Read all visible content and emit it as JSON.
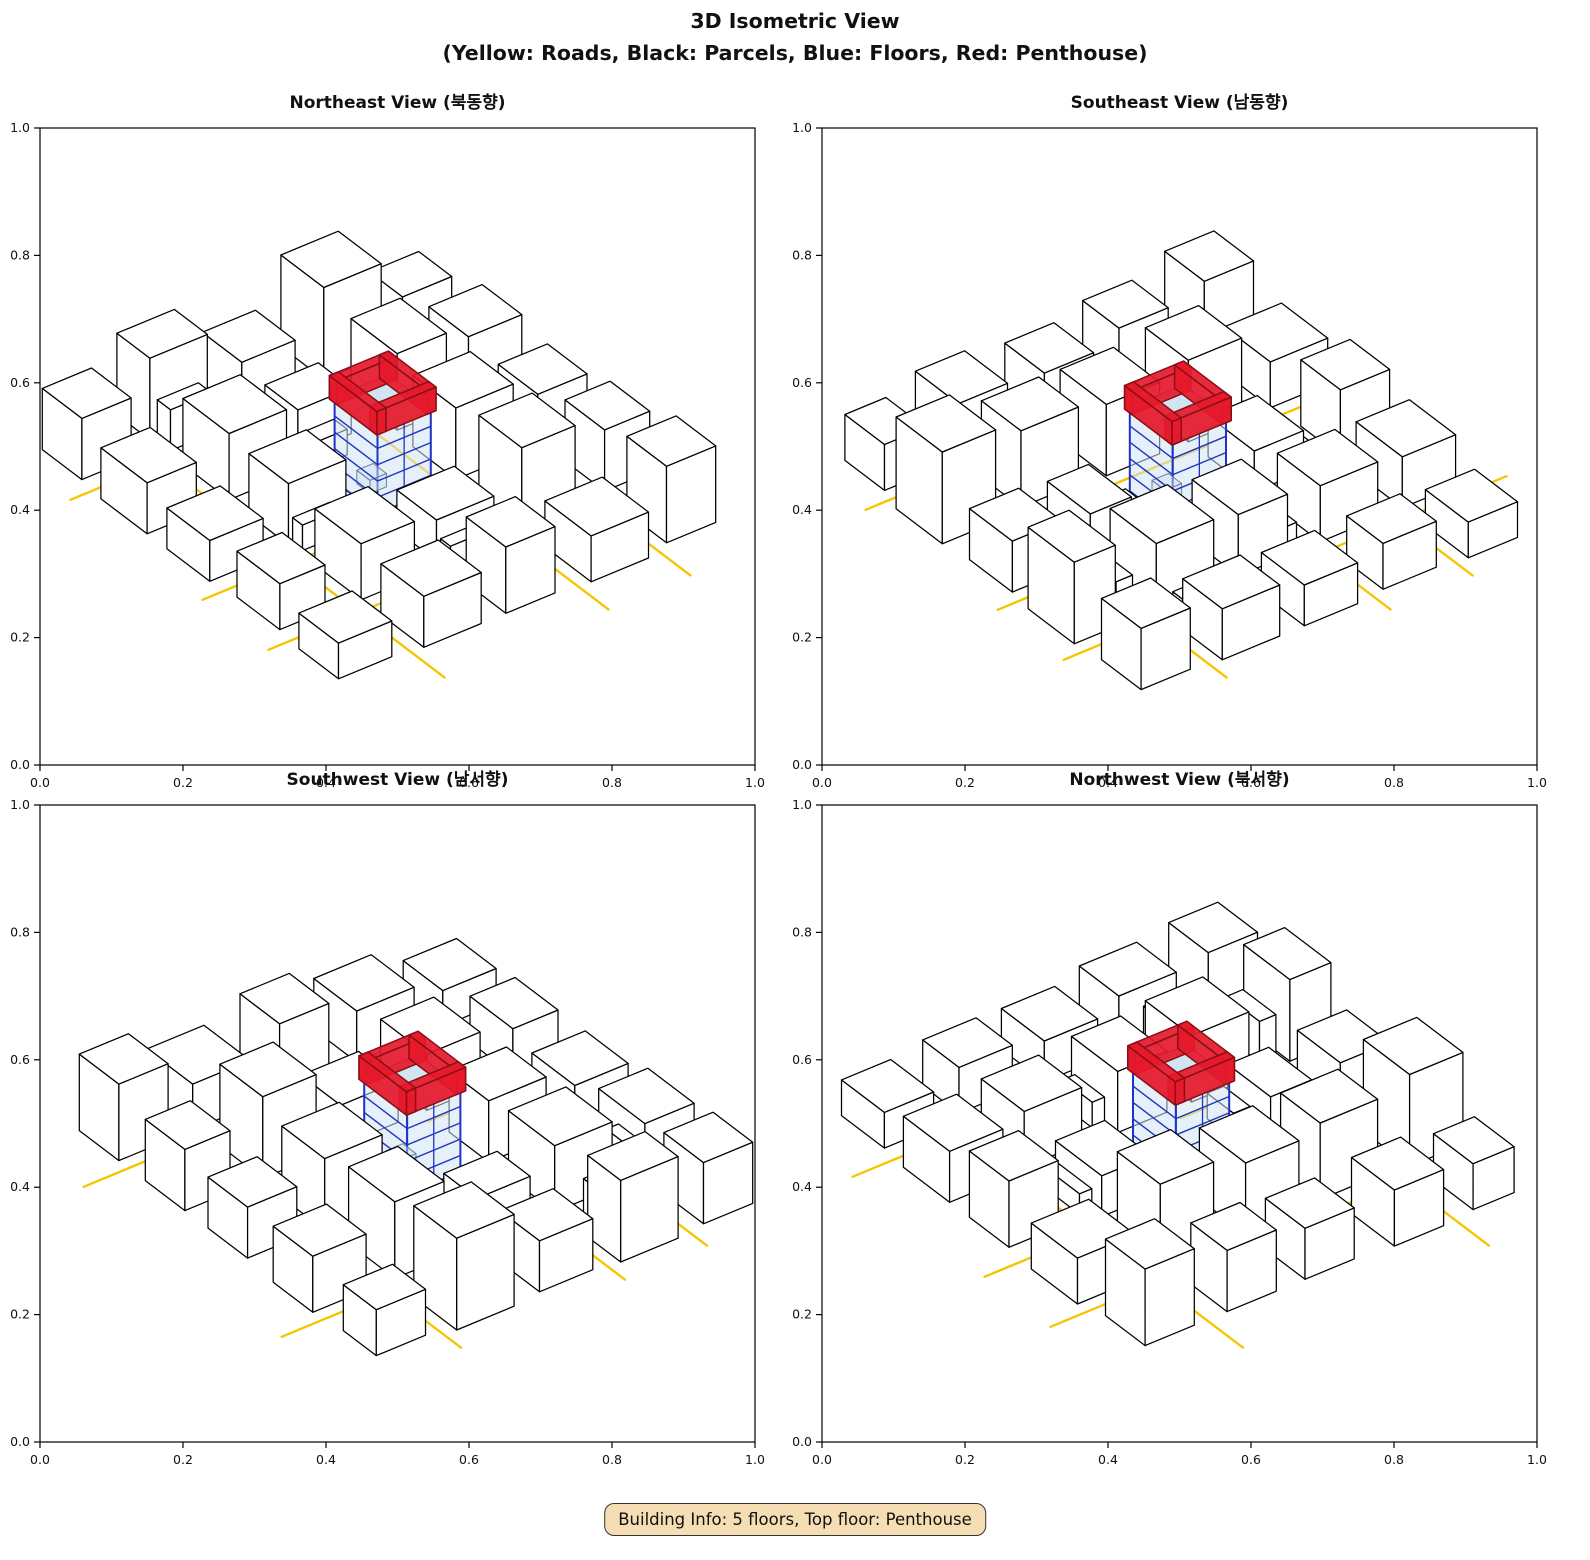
{
  "figure": {
    "title_line1": "3D Isometric View",
    "title_line2": "(Yellow: Roads, Black: Parcels, Blue: Floors, Red: Penthouse)"
  },
  "legend": {
    "roads": "Yellow",
    "parcels": "Black",
    "floors": "Blue",
    "penthouse": "Red"
  },
  "panels": [
    {
      "id": "northeast",
      "title": "Northeast View (북동향)",
      "rotation": 0
    },
    {
      "id": "southeast",
      "title": "Southeast View (남동향)",
      "rotation": 1
    },
    {
      "id": "southwest",
      "title": "Southwest View (남서향)",
      "rotation": 2
    },
    {
      "id": "northwest",
      "title": "Northwest View (북서향)",
      "rotation": 3
    }
  ],
  "axes": {
    "tick_labels": [
      "0.0",
      "0.2",
      "0.4",
      "0.6",
      "0.8",
      "1.0"
    ],
    "min": 0,
    "max": 1
  },
  "badge": {
    "text": "Building Info: 5 floors, Top floor: Penthouse"
  },
  "building_info": {
    "floors": 5,
    "top_floor": "Penthouse"
  },
  "colors": {
    "road": "#F5C500",
    "parcel_edge": "#000000",
    "building_fill": "#FFFFFF",
    "floor_fill": "#CFE3F2",
    "floor_edge": "#2033C4",
    "penthouse_fill": "#E6192B",
    "penthouse_edge": "#8A0E16",
    "badge_bg": "#F5DEB3",
    "badge_border": "#333333"
  },
  "scene": {
    "size": 100,
    "roads": [
      [
        [
          18,
          -4
        ],
        [
          18,
          104
        ]
      ],
      [
        [
          -4,
          18
        ],
        [
          104,
          18
        ]
      ],
      [
        [
          58,
          20
        ],
        [
          58,
          104
        ]
      ],
      [
        [
          -4,
          58
        ],
        [
          36,
          58
        ]
      ],
      [
        [
          78,
          -4
        ],
        [
          78,
          104
        ]
      ],
      [
        [
          -4,
          78
        ],
        [
          104,
          78
        ]
      ],
      [
        [
          38,
          -4
        ],
        [
          38,
          40
        ]
      ]
    ],
    "buildings": [
      [
        2,
        2,
        12,
        12,
        12
      ],
      [
        21,
        1,
        14,
        10,
        16
      ],
      [
        22,
        12,
        10,
        4,
        8
      ],
      [
        41,
        2,
        13,
        12,
        10
      ],
      [
        61,
        1,
        14,
        13,
        18
      ],
      [
        81,
        3,
        12,
        10,
        9
      ],
      [
        1,
        21,
        12,
        14,
        10
      ],
      [
        13,
        21,
        3,
        8,
        6
      ],
      [
        21,
        21,
        14,
        14,
        13
      ],
      [
        41,
        21,
        13,
        10,
        9
      ],
      [
        41,
        32,
        8,
        4,
        5
      ],
      [
        62,
        21,
        12,
        14,
        15
      ],
      [
        81,
        21,
        13,
        12,
        11
      ],
      [
        1,
        41,
        13,
        13,
        8
      ],
      [
        21,
        41,
        14,
        12,
        12
      ],
      [
        22,
        53,
        9,
        3,
        5
      ],
      [
        61,
        41,
        14,
        13,
        14
      ],
      [
        81,
        42,
        12,
        12,
        10
      ],
      [
        2,
        61,
        11,
        13,
        9
      ],
      [
        21,
        61,
        13,
        14,
        11
      ],
      [
        41,
        61,
        14,
        12,
        8
      ],
      [
        42,
        73,
        10,
        3,
        4
      ],
      [
        61,
        61,
        13,
        13,
        16
      ],
      [
        82,
        61,
        11,
        12,
        12
      ],
      [
        1,
        81,
        13,
        12,
        7
      ],
      [
        21,
        81,
        14,
        13,
        10
      ],
      [
        41,
        82,
        12,
        12,
        13
      ],
      [
        61,
        81,
        14,
        14,
        9
      ],
      [
        81,
        81,
        12,
        12,
        15
      ]
    ],
    "highlight": {
      "x": 41.5,
      "y": 41.5,
      "w": 13,
      "d": 13,
      "floors": 5,
      "floor_height": 3.2,
      "penthouse_height": 4.6,
      "wall_thickness": 2.2
    }
  }
}
